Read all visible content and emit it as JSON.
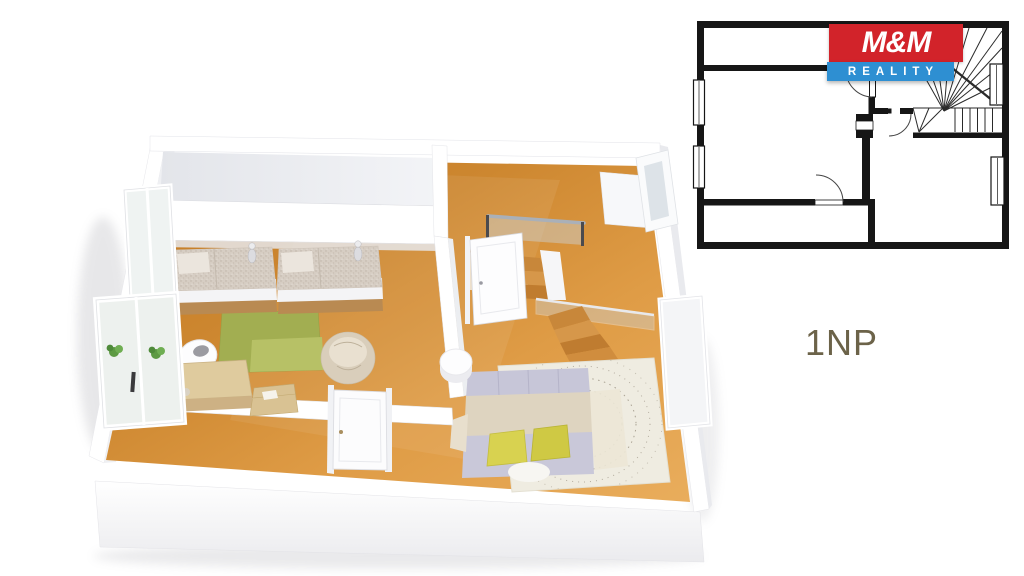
{
  "logo": {
    "brand": "M&M",
    "tagline": "REALITY",
    "brand_bg": "#d2232a",
    "tagline_bg": "#2e8fd2",
    "text_color": "#ffffff"
  },
  "floor_label": "1NP",
  "floor_label_color": "#6c6349",
  "palette": {
    "wood_floor": "#cd8730",
    "wood_floor_light": "#e9ad5c",
    "wall_white": "#ffffff",
    "wall_shade": "#e9eaee",
    "rug_green": "#a2ae51",
    "rug_green_light": "#b7c166",
    "kids_bed_linen": "#d6cdc3",
    "master_headboard": "#c7c6d8",
    "master_blanket": "#ded4c0",
    "pillow_yellow": "#d7d14e",
    "shag_rug": "#efece1",
    "plan_wall_black": "#161616"
  }
}
